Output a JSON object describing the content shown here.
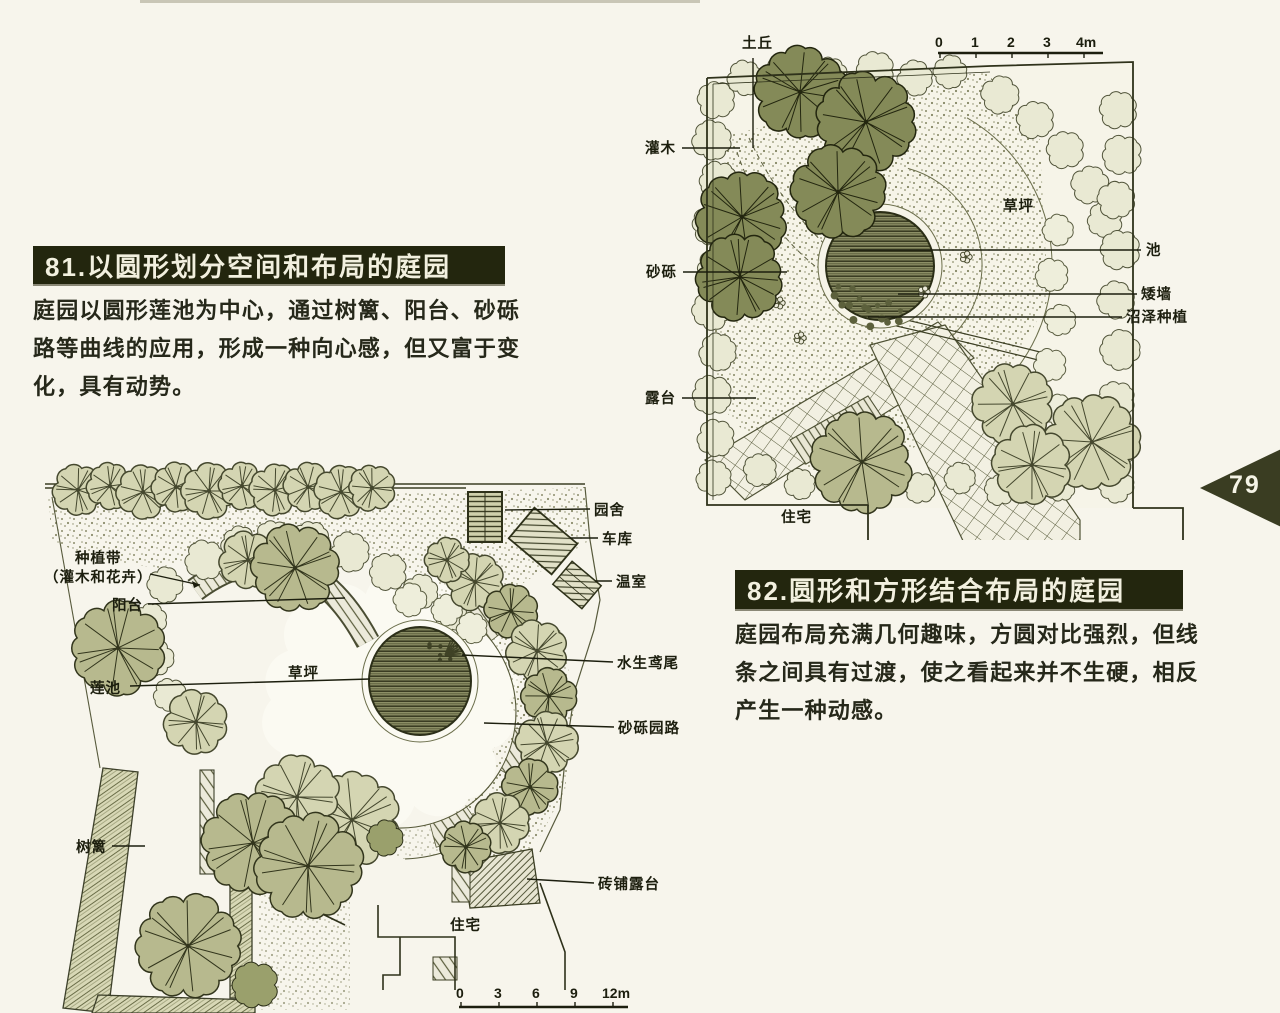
{
  "page": {
    "number": "79"
  },
  "colors": {
    "title_bar": "#23260e",
    "title_text": "#f2f0df",
    "page_tab": "#3a3d22",
    "ink": "#23250f",
    "paper": "#f7f5ec"
  },
  "section81": {
    "title": "81.以圆形划分空间和布局的庭园",
    "lines": [
      "庭园以圆形莲池为中心，通过树篱、阳台、砂砾",
      "路等曲线的应用，形成一种向心感，但又富于变",
      "化，具有动势。"
    ]
  },
  "section82": {
    "title": "82.圆形和方形结合布局的庭园",
    "lines": [
      "庭园布局充满几何趣味，方圆对比强烈，但线",
      "条之间具有过渡，使之看起来并不生硬，相反",
      "产生一种动感。"
    ]
  },
  "diagram81": {
    "labels": {
      "mound": "土丘",
      "shrub": "灌木",
      "gravel": "砂砾",
      "terrace": "露台",
      "house": "住宅",
      "lawn": "草坪",
      "pond": "池",
      "low_wall": "矮墙",
      "marsh": "沼泽种植"
    },
    "scale": {
      "t0": "0",
      "t1": "1",
      "t2": "2",
      "t3": "3",
      "t4": "4m"
    }
  },
  "diagram82": {
    "labels": {
      "belt1": "种植带",
      "belt2": "（灌木和花卉）",
      "balcony": "阳台",
      "lotus": "莲池",
      "lawn": "草坪",
      "hedge": "树篱",
      "cottage": "园舍",
      "garage": "车库",
      "greenhouse": "温室",
      "iris": "水生鸢尾",
      "gravel_path": "砂砾园路",
      "brick_terrace": "砖铺露台",
      "house": "住宅"
    },
    "scale": {
      "t0": "0",
      "t1": "3",
      "t2": "6",
      "t3": "9",
      "t4": "12m"
    }
  }
}
